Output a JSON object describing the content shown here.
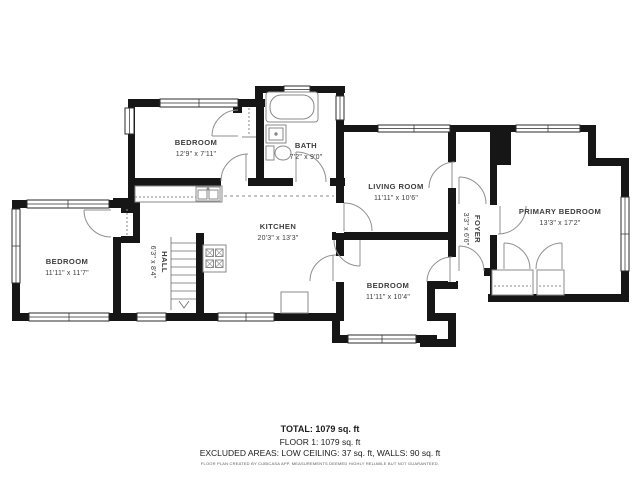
{
  "plan": {
    "rooms": [
      {
        "id": "bedroom-top",
        "name": "BEDROOM",
        "dims": "12'9\" x 7'11\""
      },
      {
        "id": "bath",
        "name": "BATH",
        "dims": "7'2\" x 9'0\""
      },
      {
        "id": "living-room",
        "name": "LIVING ROOM",
        "dims": "11'11\" x 10'6\""
      },
      {
        "id": "primary-bedroom",
        "name": "PRIMARY BEDROOM",
        "dims": "13'3\" x 17'2\""
      },
      {
        "id": "bedroom-left",
        "name": "BEDROOM",
        "dims": "11'11\" x 11'7\""
      },
      {
        "id": "kitchen",
        "name": "KITCHEN",
        "dims": "20'3\" x 13'3\""
      },
      {
        "id": "hall",
        "name": "HALL",
        "dims": "6'3\" x 8'4\""
      },
      {
        "id": "bedroom-bottom",
        "name": "BEDROOM",
        "dims": "11'11\" x 10'4\""
      },
      {
        "id": "foyer",
        "name": "FOYER",
        "dims": "3'3\" x 6'6\""
      }
    ],
    "summary": {
      "total": "TOTAL: 1079 sq. ft",
      "floor1": "FLOOR 1: 1079 sq. ft",
      "excluded": "EXCLUDED AREAS: LOW CEILING: 37 sq. ft, WALLS: 90 sq. ft",
      "disclaimer": "FLOOR PLAN CREATED BY CUBICASA APP. MEASUREMENTS DEEMED HIGHLY RELIABLE BUT NOT GUARANTEED."
    },
    "colors": {
      "wall": "#161616",
      "background": "#ffffff",
      "door_arc": "#8f8f8f",
      "fixture": "#8a8a8a",
      "label_text": "#3d3d3d"
    }
  }
}
